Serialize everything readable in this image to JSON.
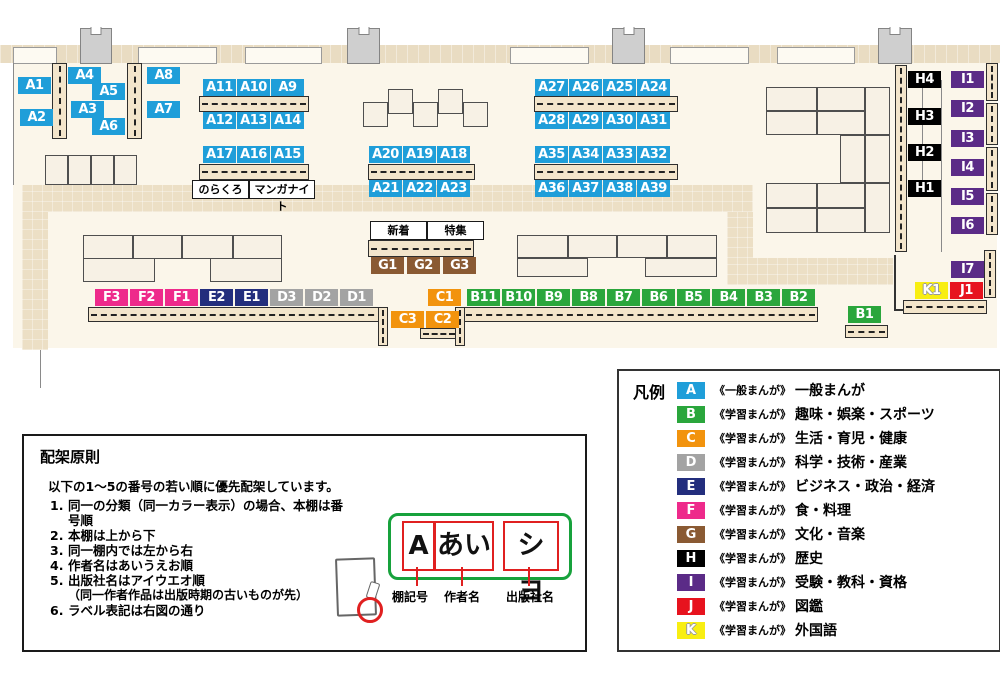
{
  "colors": {
    "A": "#1f9ed9",
    "B": "#2aa63c",
    "C": "#f2930d",
    "D": "#a3a3a3",
    "E": "#232e7d",
    "F": "#ee2a8b",
    "G": "#8a5a33",
    "H": "#000000",
    "I": "#5b2b87",
    "J": "#e7131e",
    "K": "#f8ee12"
  },
  "map": {
    "labels": [
      {
        "id": "A1",
        "cat": "A",
        "x": 18,
        "y": 77
      },
      {
        "id": "A2",
        "cat": "A",
        "x": 20,
        "y": 109
      },
      {
        "id": "A4",
        "cat": "A",
        "x": 68,
        "y": 67
      },
      {
        "id": "A5",
        "cat": "A",
        "x": 92,
        "y": 83
      },
      {
        "id": "A3",
        "cat": "A",
        "x": 71,
        "y": 101
      },
      {
        "id": "A6",
        "cat": "A",
        "x": 92,
        "y": 118
      },
      {
        "id": "A8",
        "cat": "A",
        "x": 147,
        "y": 67
      },
      {
        "id": "A7",
        "cat": "A",
        "x": 147,
        "y": 101
      },
      {
        "id": "A11",
        "cat": "A",
        "x": 203,
        "y": 79
      },
      {
        "id": "A10",
        "cat": "A",
        "x": 237,
        "y": 79
      },
      {
        "id": "A9",
        "cat": "A",
        "x": 271,
        "y": 79
      },
      {
        "id": "A12",
        "cat": "A",
        "x": 203,
        "y": 112
      },
      {
        "id": "A13",
        "cat": "A",
        "x": 237,
        "y": 112
      },
      {
        "id": "A14",
        "cat": "A",
        "x": 271,
        "y": 112
      },
      {
        "id": "A17",
        "cat": "A",
        "x": 203,
        "y": 146
      },
      {
        "id": "A16",
        "cat": "A",
        "x": 237,
        "y": 146
      },
      {
        "id": "A15",
        "cat": "A",
        "x": 271,
        "y": 146
      },
      {
        "id": "A20",
        "cat": "A",
        "x": 369,
        "y": 146
      },
      {
        "id": "A19",
        "cat": "A",
        "x": 403,
        "y": 146
      },
      {
        "id": "A18",
        "cat": "A",
        "x": 437,
        "y": 146
      },
      {
        "id": "A21",
        "cat": "A",
        "x": 369,
        "y": 180
      },
      {
        "id": "A22",
        "cat": "A",
        "x": 403,
        "y": 180
      },
      {
        "id": "A23",
        "cat": "A",
        "x": 437,
        "y": 180
      },
      {
        "id": "A27",
        "cat": "A",
        "x": 535,
        "y": 79
      },
      {
        "id": "A26",
        "cat": "A",
        "x": 569,
        "y": 79
      },
      {
        "id": "A25",
        "cat": "A",
        "x": 603,
        "y": 79
      },
      {
        "id": "A24",
        "cat": "A",
        "x": 637,
        "y": 79
      },
      {
        "id": "A28",
        "cat": "A",
        "x": 535,
        "y": 112
      },
      {
        "id": "A29",
        "cat": "A",
        "x": 569,
        "y": 112
      },
      {
        "id": "A30",
        "cat": "A",
        "x": 603,
        "y": 112
      },
      {
        "id": "A31",
        "cat": "A",
        "x": 637,
        "y": 112
      },
      {
        "id": "A35",
        "cat": "A",
        "x": 535,
        "y": 146
      },
      {
        "id": "A34",
        "cat": "A",
        "x": 569,
        "y": 146
      },
      {
        "id": "A33",
        "cat": "A",
        "x": 603,
        "y": 146
      },
      {
        "id": "A32",
        "cat": "A",
        "x": 637,
        "y": 146
      },
      {
        "id": "A36",
        "cat": "A",
        "x": 535,
        "y": 180
      },
      {
        "id": "A37",
        "cat": "A",
        "x": 569,
        "y": 180
      },
      {
        "id": "A38",
        "cat": "A",
        "x": 603,
        "y": 180
      },
      {
        "id": "A39",
        "cat": "A",
        "x": 637,
        "y": 180
      },
      {
        "id": "G1",
        "cat": "G",
        "x": 371,
        "y": 257
      },
      {
        "id": "G2",
        "cat": "G",
        "x": 407,
        "y": 257
      },
      {
        "id": "G3",
        "cat": "G",
        "x": 443,
        "y": 257
      },
      {
        "id": "F3",
        "cat": "F",
        "x": 95,
        "y": 289
      },
      {
        "id": "F2",
        "cat": "F",
        "x": 130,
        "y": 289
      },
      {
        "id": "F1",
        "cat": "F",
        "x": 165,
        "y": 289
      },
      {
        "id": "E2",
        "cat": "E",
        "x": 200,
        "y": 289
      },
      {
        "id": "E1",
        "cat": "E",
        "x": 235,
        "y": 289
      },
      {
        "id": "D3",
        "cat": "D",
        "x": 270,
        "y": 289
      },
      {
        "id": "D2",
        "cat": "D",
        "x": 305,
        "y": 289
      },
      {
        "id": "D1",
        "cat": "D",
        "x": 340,
        "y": 289
      },
      {
        "id": "C1",
        "cat": "C",
        "x": 428,
        "y": 289
      },
      {
        "id": "C3",
        "cat": "C",
        "x": 391,
        "y": 311
      },
      {
        "id": "C2",
        "cat": "C",
        "x": 426,
        "y": 311
      },
      {
        "id": "B11",
        "cat": "B",
        "x": 467,
        "y": 289
      },
      {
        "id": "B10",
        "cat": "B",
        "x": 502,
        "y": 289
      },
      {
        "id": "B9",
        "cat": "B",
        "x": 537,
        "y": 289
      },
      {
        "id": "B8",
        "cat": "B",
        "x": 572,
        "y": 289
      },
      {
        "id": "B7",
        "cat": "B",
        "x": 607,
        "y": 289
      },
      {
        "id": "B6",
        "cat": "B",
        "x": 642,
        "y": 289
      },
      {
        "id": "B5",
        "cat": "B",
        "x": 677,
        "y": 289
      },
      {
        "id": "B4",
        "cat": "B",
        "x": 712,
        "y": 289
      },
      {
        "id": "B3",
        "cat": "B",
        "x": 747,
        "y": 289
      },
      {
        "id": "B2",
        "cat": "B",
        "x": 782,
        "y": 289
      },
      {
        "id": "B1",
        "cat": "B",
        "x": 848,
        "y": 306
      },
      {
        "id": "H4",
        "cat": "H",
        "x": 908,
        "y": 71
      },
      {
        "id": "H3",
        "cat": "H",
        "x": 908,
        "y": 108
      },
      {
        "id": "H2",
        "cat": "H",
        "x": 908,
        "y": 144
      },
      {
        "id": "H1",
        "cat": "H",
        "x": 908,
        "y": 180
      },
      {
        "id": "I1",
        "cat": "I",
        "x": 951,
        "y": 71
      },
      {
        "id": "I2",
        "cat": "I",
        "x": 951,
        "y": 100
      },
      {
        "id": "I3",
        "cat": "I",
        "x": 951,
        "y": 130
      },
      {
        "id": "I4",
        "cat": "I",
        "x": 951,
        "y": 159
      },
      {
        "id": "I5",
        "cat": "I",
        "x": 951,
        "y": 188
      },
      {
        "id": "I6",
        "cat": "I",
        "x": 951,
        "y": 217
      },
      {
        "id": "I7",
        "cat": "I",
        "x": 951,
        "y": 261
      },
      {
        "id": "K1",
        "cat": "K",
        "x": 915,
        "y": 282
      },
      {
        "id": "J1",
        "cat": "J",
        "x": 950,
        "y": 282
      }
    ],
    "annotations": {
      "norakuro": "のらくろ",
      "manganight": "マンガナイト",
      "shinchaku": "新着",
      "tokushu": "特集"
    }
  },
  "legend": {
    "title": "凡例",
    "items": [
      {
        "letter": "A",
        "color": "#1f9ed9",
        "kicker": "《一般まんが》",
        "label": "一般まんが"
      },
      {
        "letter": "B",
        "color": "#2aa63c",
        "kicker": "《学習まんが》",
        "label": "趣味・娯楽・スポーツ"
      },
      {
        "letter": "C",
        "color": "#f2930d",
        "kicker": "《学習まんが》",
        "label": "生活・育児・健康"
      },
      {
        "letter": "D",
        "color": "#a3a3a3",
        "kicker": "《学習まんが》",
        "label": "科学・技術・産業"
      },
      {
        "letter": "E",
        "color": "#232e7d",
        "kicker": "《学習まんが》",
        "label": "ビジネス・政治・経済"
      },
      {
        "letter": "F",
        "color": "#ee2a8b",
        "kicker": "《学習まんが》",
        "label": "食・料理"
      },
      {
        "letter": "G",
        "color": "#8a5a33",
        "kicker": "《学習まんが》",
        "label": "文化・音楽"
      },
      {
        "letter": "H",
        "color": "#000000",
        "kicker": "《学習まんが》",
        "label": "歴史"
      },
      {
        "letter": "I",
        "color": "#5b2b87",
        "kicker": "《学習まんが》",
        "label": "受験・教科・資格"
      },
      {
        "letter": "J",
        "color": "#e7131e",
        "kicker": "《学習まんが》",
        "label": "図鑑"
      },
      {
        "letter": "K",
        "color": "#f8ee12",
        "kicker": "《学習まんが》",
        "label": "外国語",
        "letter_style": "outline"
      }
    ]
  },
  "principles": {
    "title": "配架原則",
    "intro": "以下の1～5の番号の若い順に優先配架しています。",
    "items": [
      {
        "no": "1.",
        "text": "同一の分類（同一カラー表示）の場合、本棚は番号順"
      },
      {
        "no": "2.",
        "text": "本棚は上から下"
      },
      {
        "no": "3.",
        "text": "同一棚内では左から右"
      },
      {
        "no": "4.",
        "text": "作者名はあいうえお順"
      },
      {
        "no": "5.",
        "text": "出版社名はアイウエオ順",
        "sub": "（同一作者作品は出版時期の古いものが先）"
      },
      {
        "no": "6.",
        "text": "ラベル表記は右図の通り"
      }
    ],
    "label_diagram": {
      "cells": [
        "A",
        "あい",
        "シヨ"
      ],
      "callouts": [
        "棚記号",
        "作者名",
        "出版社名"
      ]
    }
  }
}
